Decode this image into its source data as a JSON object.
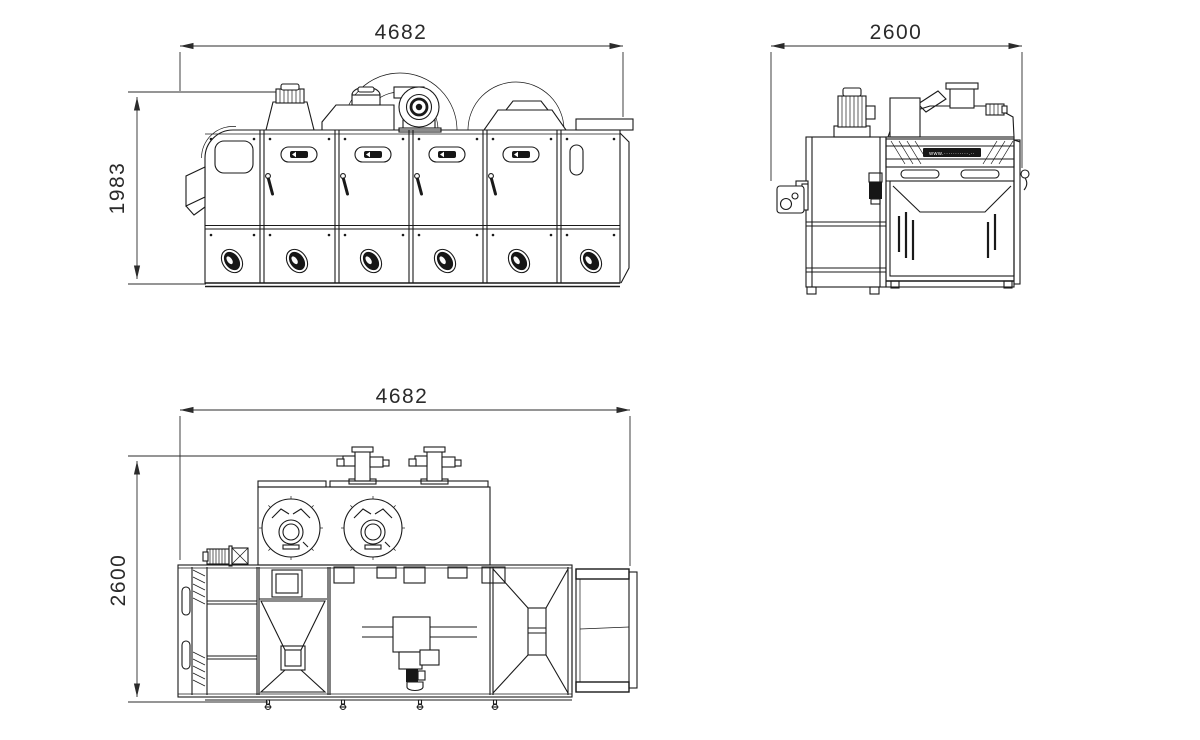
{
  "views": {
    "front": {
      "width_label": "4682",
      "height_label": "1983"
    },
    "side": {
      "width_label": "2600"
    },
    "plan": {
      "width_label": "4682",
      "depth_label": "2600"
    }
  },
  "branding": {
    "url_band": "www.···········.··"
  },
  "colors": {
    "background": "#ffffff",
    "line": "#1a1a1a",
    "dim_text": "#2b2b2b"
  }
}
